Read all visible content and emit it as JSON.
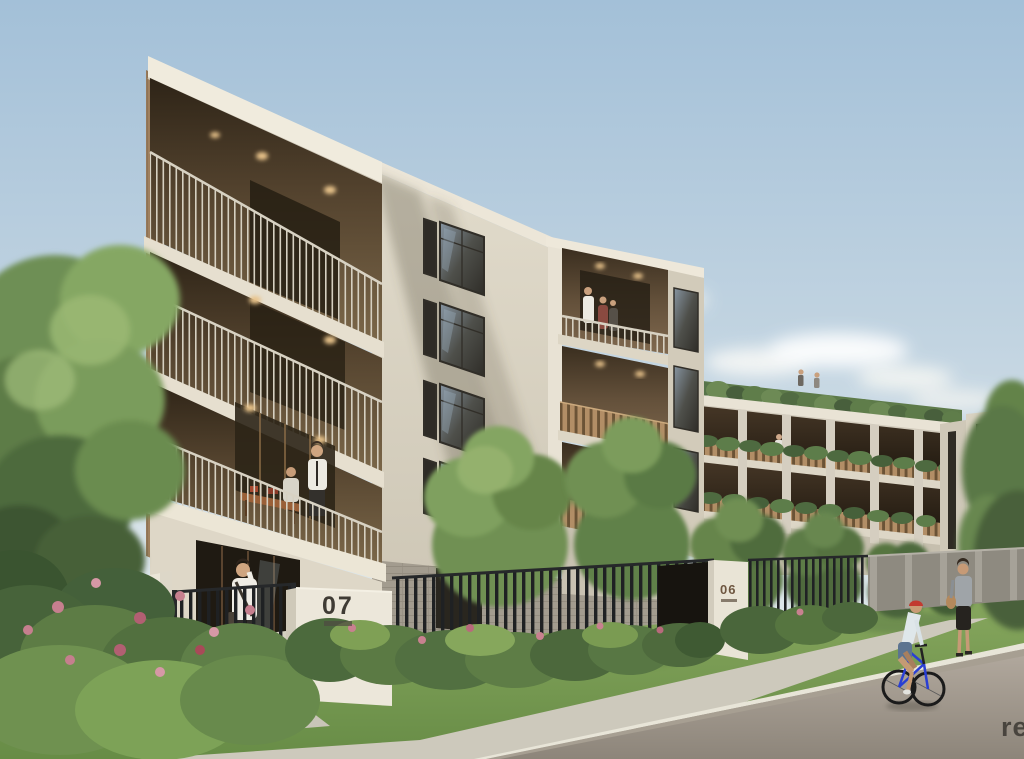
{
  "image": {
    "title": "Residential apartment complex exterior render",
    "type": "architectural-visualization"
  },
  "signs": {
    "building_07": {
      "number": "07"
    },
    "building_06": {
      "number": "06"
    }
  },
  "watermark": {
    "text": "re"
  },
  "palette": {
    "sky_top": "#a3c0d8",
    "sky_horizon": "#e8edec",
    "wall_cream": "#d9d2c2",
    "fascia_white": "#efe9db",
    "balcony_timber": "#b08c64",
    "balcony_shadow": "#3a2e1f",
    "window_glass": "#4e4f4a",
    "fence_black": "#1f2123",
    "foliage_green": "#6f9052",
    "flower_pink": "#c8818f",
    "grass_green": "#7aa05a",
    "path_concrete": "#cdc9bc",
    "road_asphalt": "#9a9287",
    "sign_text_dark": "#3f3b34",
    "sign_text_bronze": "#6e5640",
    "helmet_red": "#c23a30",
    "bike_blue": "#2a3fd4"
  }
}
